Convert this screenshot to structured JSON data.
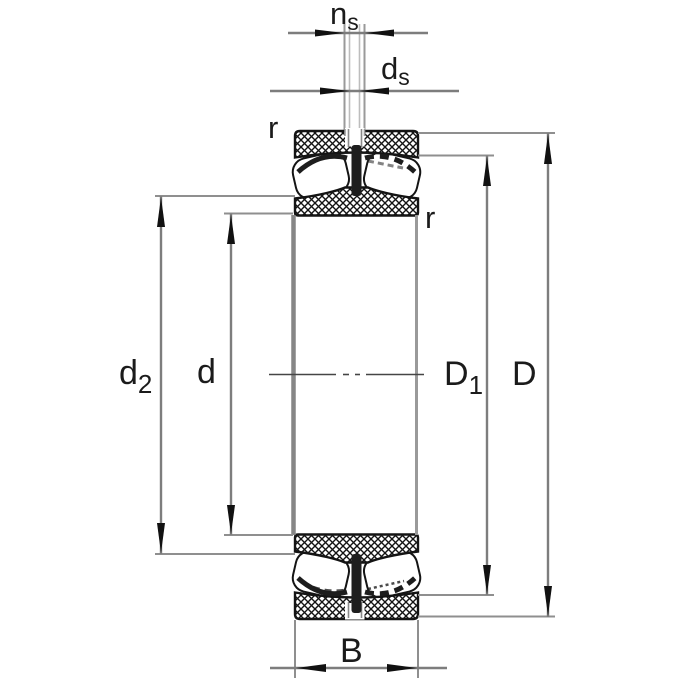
{
  "figure": {
    "type": "engineering-drawing",
    "subject": "spherical-roller-bearing-axial-cross-section",
    "background": "#ffffff",
    "ink_color": "#141414",
    "dimension_line_color": "#7d7d7d",
    "extension_line_color": "#8f8f8f",
    "centerline_color": "#454545"
  },
  "dimensions": {
    "ns": {
      "base": "n",
      "sub": "s"
    },
    "ds": {
      "base": "d",
      "sub": "s"
    },
    "r_outer": {
      "base": "r",
      "sub": ""
    },
    "r_inner": {
      "base": "r",
      "sub": ""
    },
    "d2": {
      "base": "d",
      "sub": "2"
    },
    "d": {
      "base": "d",
      "sub": ""
    },
    "D1": {
      "base": "D",
      "sub": "1"
    },
    "D": {
      "base": "D",
      "sub": ""
    },
    "B": {
      "base": "B",
      "sub": ""
    }
  }
}
